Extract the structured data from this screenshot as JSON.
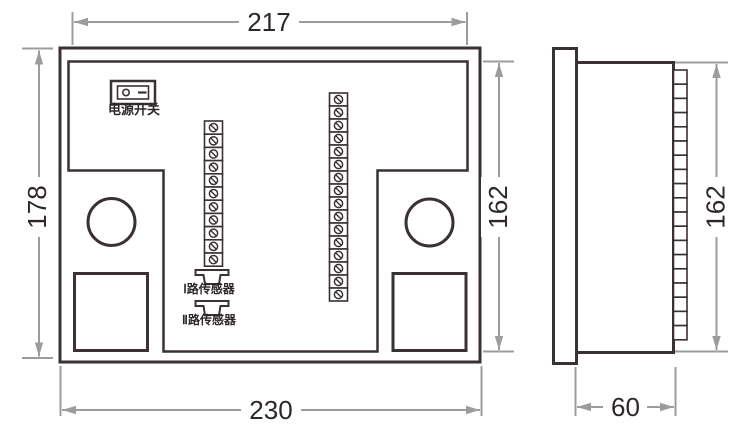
{
  "drawing": {
    "colors": {
      "line": "#3a3132",
      "dimension": "#9c9c9c",
      "text": "#2e2727"
    },
    "front_view": {
      "power_switch_label": "电源开关",
      "sensor_channel_1_label": "Ⅰ路传感器",
      "sensor_channel_2_label": "Ⅱ路传感器",
      "left_terminal_count": 11,
      "right_terminal_count": 16,
      "dim_top_width": "217",
      "dim_left_height": "178",
      "dim_right_height": "162",
      "dim_bottom_width": "230"
    },
    "side_view": {
      "terminal_count": 19,
      "dim_height": "162",
      "dim_depth": "60"
    }
  }
}
